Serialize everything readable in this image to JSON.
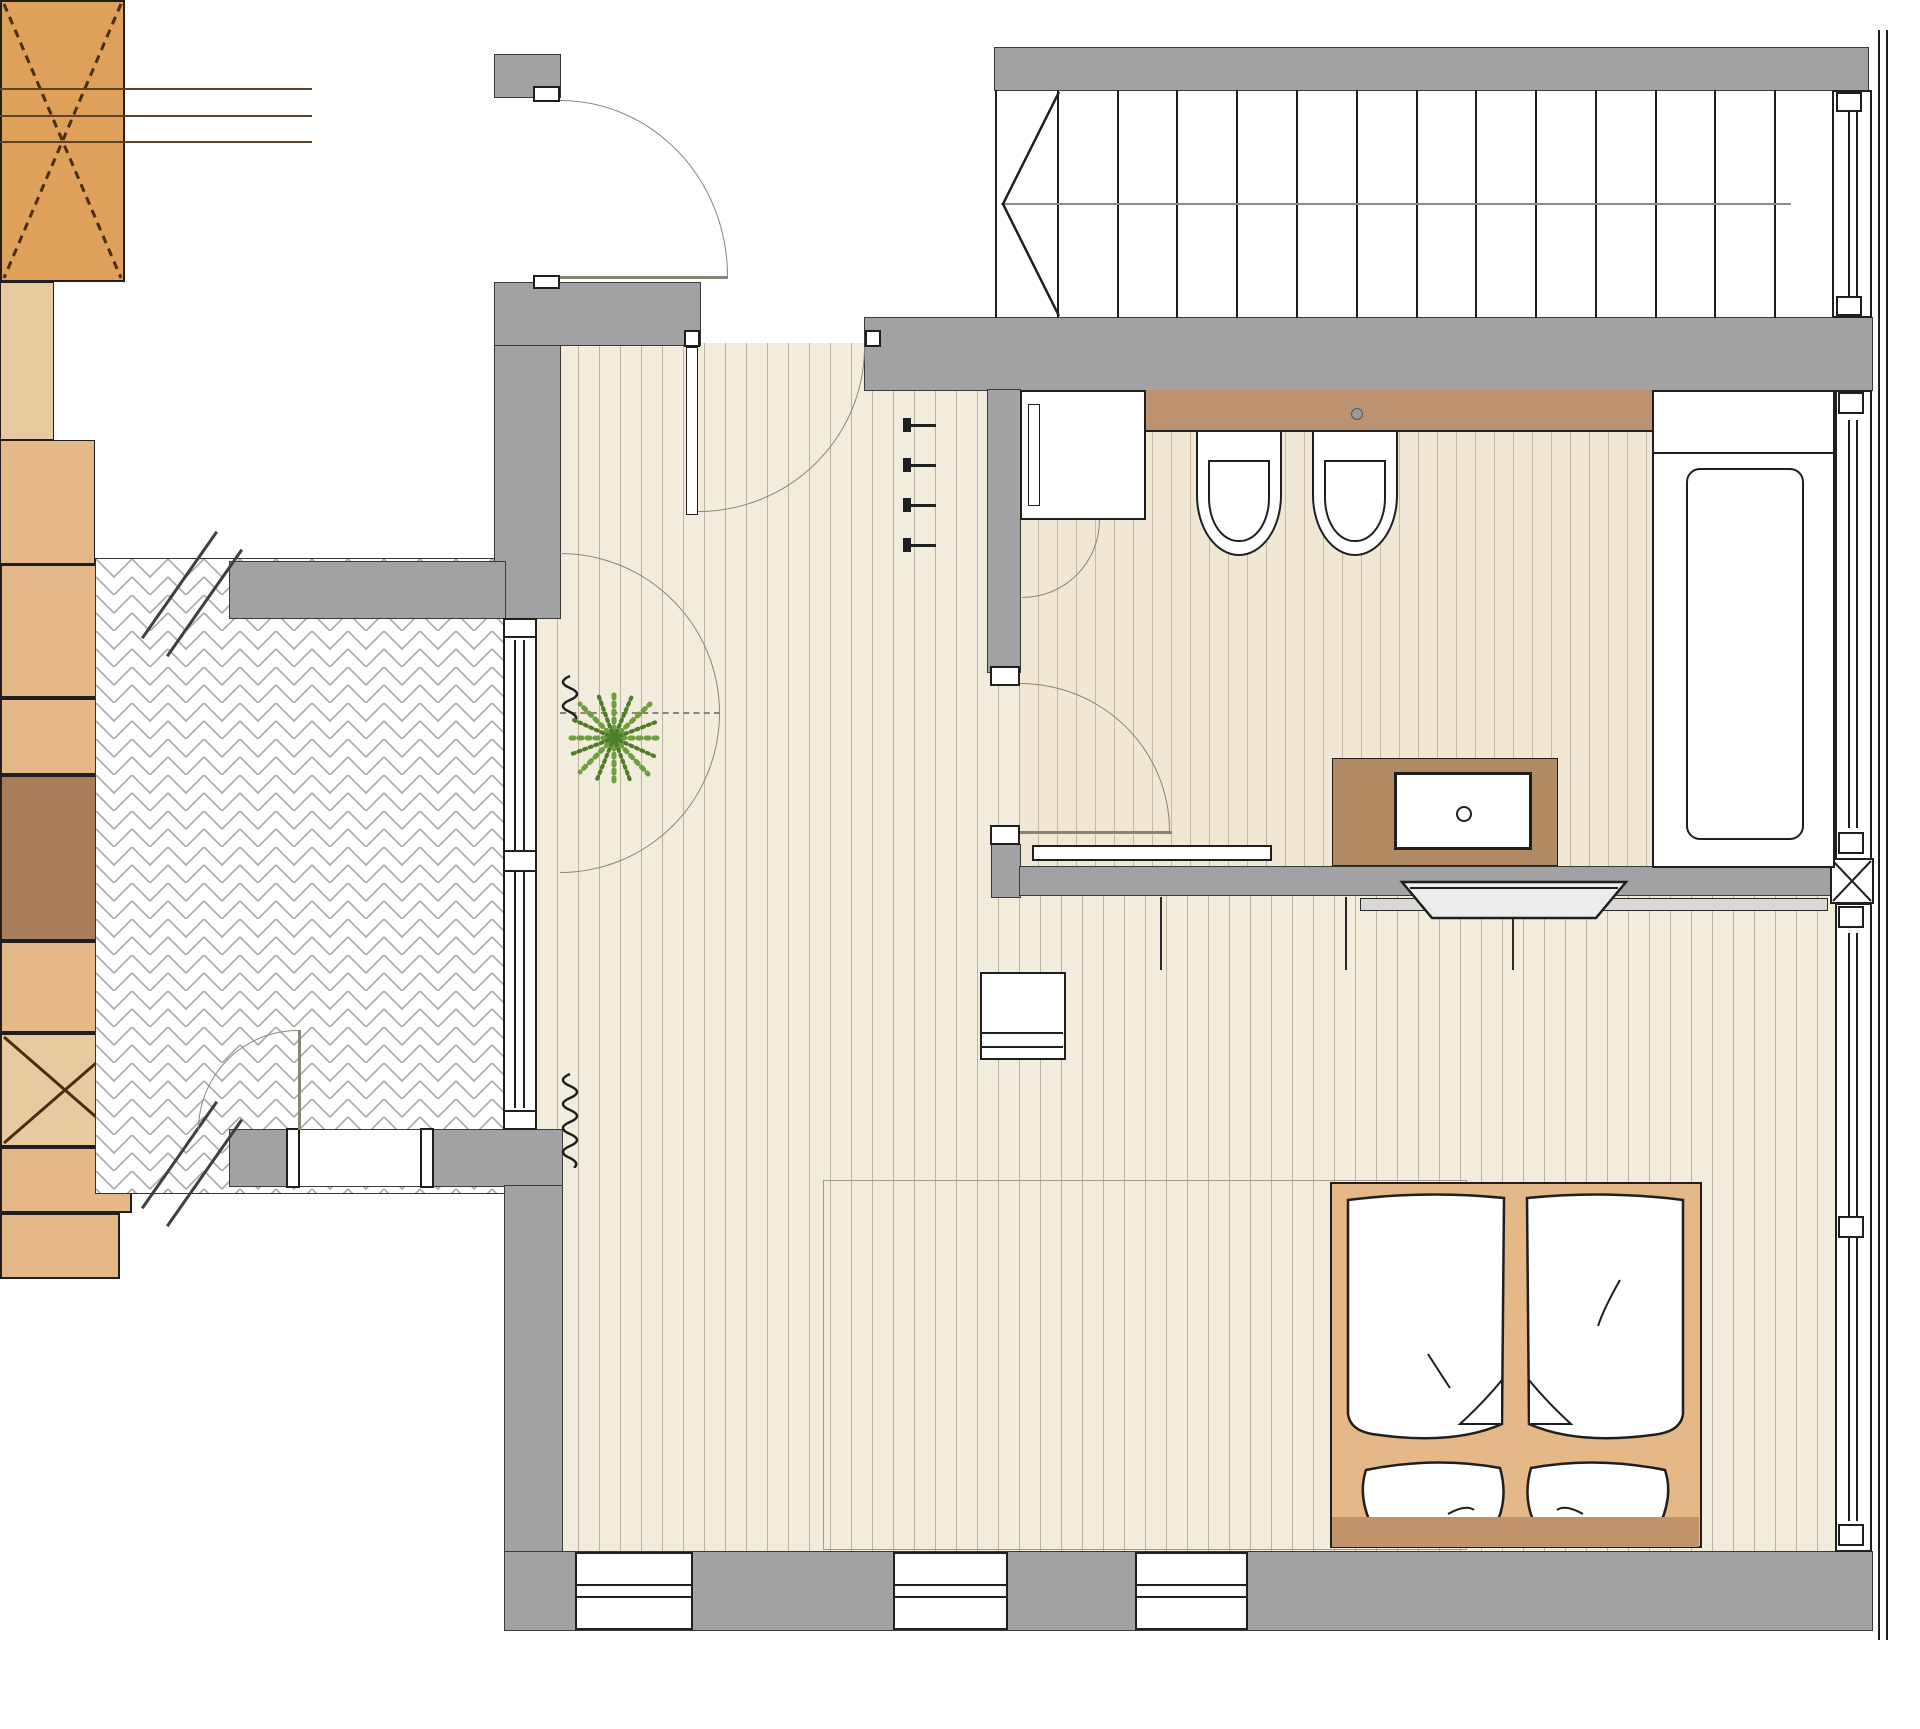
{
  "document": {
    "type": "architectural-floor-plan",
    "description": "top-view plan of a hotel room / small apartment with terrace, entry hall, bathroom, bedroom-living area and a staircase",
    "visible_text": []
  },
  "colors": {
    "wall": "#a2a2a4",
    "wall_outline": "#3a3a3a",
    "floor": "#f2ecdc",
    "floor_stripe": "#bcb3a1",
    "bath_floor": "#f0e8d5",
    "bath_stripe": "#c8baa3",
    "wood_orange": "#dfa059",
    "wood_tan": "#e4b887",
    "wood_tan_light": "#e9c9a0",
    "wood_brown": "#aa7e5b",
    "wood_mid": "#c0936a",
    "ledge_brown": "#bc9270",
    "vanity_brown": "#b08a63",
    "line_black": "#1f1f1f",
    "arc_gray": "#8b8578",
    "plant_green": "#6f9e3f",
    "plant_green_dark": "#4e7c28",
    "rug_line": "#a39a87",
    "paving_line": "#a9a9a9"
  },
  "stairs": {
    "tread_count": 14,
    "direction_line": true,
    "start_arrow": "left"
  },
  "rooms": [
    {
      "name": "terrace",
      "finish": "herringbone-paving"
    },
    {
      "name": "entry-hall",
      "finish": "wood-plank"
    },
    {
      "name": "bathroom",
      "finish": "wood-plank"
    },
    {
      "name": "bedroom-living",
      "finish": "wood-plank"
    }
  ],
  "elements": [
    {
      "name": "entry-door",
      "kind": "swing-door"
    },
    {
      "name": "hall-inner-door",
      "kind": "swing-door"
    },
    {
      "name": "bathroom-door",
      "kind": "swing-door"
    },
    {
      "name": "terrace-door",
      "kind": "swing-door"
    },
    {
      "name": "terrace-window-door",
      "kind": "double-swing-symbol"
    },
    {
      "name": "wardrobe",
      "kind": "cabinet-with-x"
    },
    {
      "name": "coat-rack",
      "kind": "rail-with-4-hooks"
    },
    {
      "name": "coat-cabinet",
      "kind": "cabinet"
    },
    {
      "name": "plant",
      "kind": "potted-plant"
    },
    {
      "name": "curtain-symbol",
      "kind": "squiggle",
      "count": 2
    },
    {
      "name": "shower",
      "kind": "shower-cabin"
    },
    {
      "name": "bidet",
      "kind": "sanitary"
    },
    {
      "name": "toilet",
      "kind": "sanitary"
    },
    {
      "name": "bathtub",
      "kind": "sanitary"
    },
    {
      "name": "washbasin-vanity",
      "kind": "counter-with-sink"
    },
    {
      "name": "towel-rail",
      "kind": "rail"
    },
    {
      "name": "sideboard-counter",
      "kind": "long-counter"
    },
    {
      "name": "tv",
      "kind": "flat-screen"
    },
    {
      "name": "desk-stool",
      "kind": "seat"
    },
    {
      "name": "sofa-bench",
      "kind": "seat"
    },
    {
      "name": "coffee-table",
      "kind": "table"
    },
    {
      "name": "side-stool",
      "kind": "stool-with-x"
    },
    {
      "name": "rug",
      "kind": "rug-outline"
    },
    {
      "name": "double-bed",
      "kind": "bed",
      "duvets": 2,
      "pillows": 2
    },
    {
      "name": "nightstand",
      "kind": "table",
      "count": 2
    },
    {
      "name": "wall-break-symbol",
      "kind": "double-slash",
      "count": 2
    },
    {
      "name": "window-column",
      "kind": "x-marked-post"
    }
  ]
}
